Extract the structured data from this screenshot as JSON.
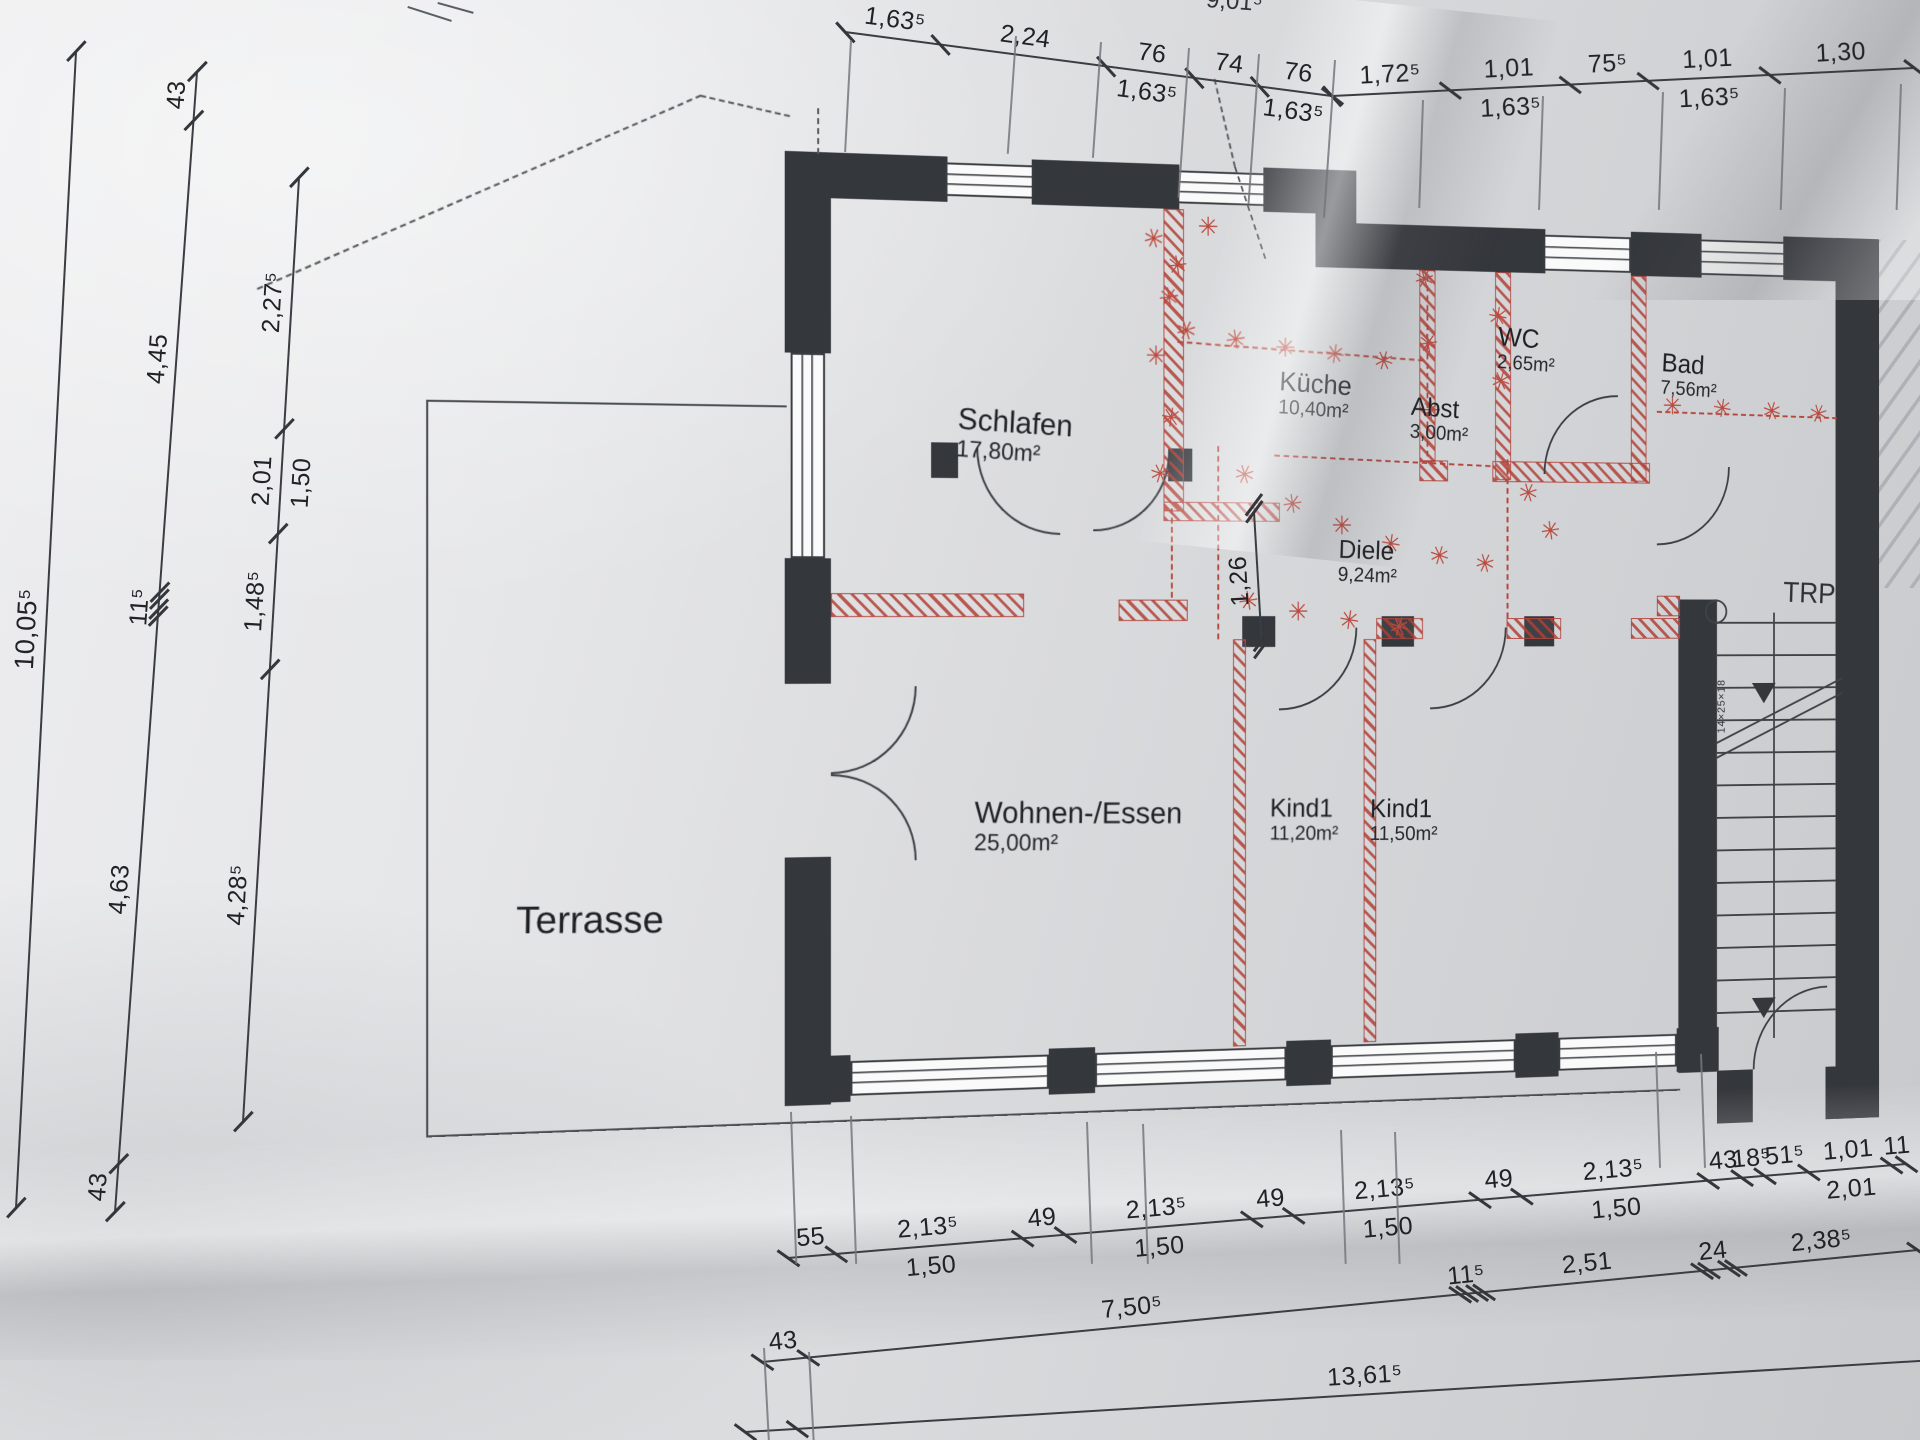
{
  "meta": {
    "kind": "photographed architectural floor plan, German labels"
  },
  "colors": {
    "paper": "#e6e7e9",
    "ink": "#33363b",
    "wall_black": "#34373c",
    "demolition_red": "#b2463e",
    "mark_red": "#bc493e",
    "hatch_gray": "#aeb1b5"
  },
  "labels": {
    "trpha": "TRPHA.",
    "stair_annotation": "14×25×18",
    "top_partial": "9,01⁵"
  },
  "rooms": [
    {
      "id": "schlafen",
      "name": "Schlafen",
      "area": "17,80m²",
      "x": 962,
      "y": 402,
      "size": 31,
      "rot": 3
    },
    {
      "id": "kueche",
      "name": "Küche",
      "area": "10,40m²",
      "x": 1305,
      "y": 358,
      "size": 28,
      "rot": 3
    },
    {
      "id": "abst",
      "name": "Abst",
      "area": "3,00m²",
      "x": 1450,
      "y": 382,
      "size": 27,
      "rot": 3
    },
    {
      "id": "wc",
      "name": "WC",
      "area": "2,65m²",
      "x": 1548,
      "y": 306,
      "size": 28,
      "rot": 3
    },
    {
      "id": "bad",
      "name": "Bad",
      "area": "7,56m²",
      "x": 1735,
      "y": 330,
      "size": 28,
      "rot": 3
    },
    {
      "id": "diele",
      "name": "Diele",
      "area": "9,24m²",
      "x": 1370,
      "y": 532,
      "size": 27,
      "rot": 2
    },
    {
      "id": "wohnen",
      "name": "Wohnen-/Essen",
      "area": "25,00m²",
      "x": 980,
      "y": 801,
      "size": 31,
      "rot": 1
    },
    {
      "id": "kind1a",
      "name": "Kind1",
      "area": "11,20m²",
      "x": 1295,
      "y": 801,
      "size": 27,
      "rot": 1
    },
    {
      "id": "kind1b",
      "name": "Kind1",
      "area": "11,50m²",
      "x": 1405,
      "y": 803,
      "size": 27,
      "rot": 1
    },
    {
      "id": "terrasse",
      "name": "Terrasse",
      "area": "",
      "x": 518,
      "y": 896,
      "size": 38,
      "rot": 1
    }
  ],
  "dimension_chains": [
    {
      "id": "top-left",
      "x1": 845,
      "y1": 32,
      "x2": 1332,
      "y2": 96,
      "segs": [
        {
          "a": "1,63⁵",
          "len": 95
        },
        {
          "a": "2,24",
          "len": 165
        },
        {
          "a": "76",
          "b": "1,63⁵",
          "len": 88
        },
        {
          "a": "74",
          "len": 66
        },
        {
          "a": "76",
          "b": "1,63⁵",
          "len": 72
        }
      ]
    },
    {
      "id": "top-right",
      "x1": 1332,
      "y1": 96,
      "x2": 1914,
      "y2": 68,
      "segs": [
        {
          "a": "1,72⁵",
          "len": 118
        },
        {
          "a": "1,01",
          "b": "1,63⁵",
          "len": 120
        },
        {
          "a": "75⁵",
          "len": 78
        },
        {
          "a": "1,01",
          "b": "1,63⁵",
          "len": 122
        },
        {
          "a": "1,30",
          "len": 145
        }
      ]
    },
    {
      "id": "left-outer",
      "x1": 16,
      "y1": 1208,
      "x2": 76,
      "y2": 52,
      "fs": 27,
      "segs": [
        {
          "a": "10,05⁵",
          "len": 1
        }
      ]
    },
    {
      "id": "left-mid",
      "x1": 115,
      "y1": 1212,
      "x2": 197,
      "y2": 72,
      "segs": [
        {
          "a": "43",
          "len": 45
        },
        {
          "a": "4,63",
          "len": 520
        },
        {
          "a": "11⁵",
          "len": 16,
          "d": 1
        },
        {
          "a": "4,45",
          "len": 455,
          "d": 1
        },
        {
          "a": "43",
          "len": 46
        }
      ]
    },
    {
      "id": "left-inner",
      "x1": 243,
      "y1": 1122,
      "x2": 299,
      "y2": 178,
      "segs": [
        {
          "a": "4,28⁵",
          "len": 450
        },
        {
          "a": "1,48⁵",
          "len": 135
        },
        {
          "a": "2,01",
          "b": "1,50",
          "len": 105
        },
        {
          "a": "2,27⁵",
          "len": 250
        }
      ]
    },
    {
      "id": "bottom-1",
      "x1": 788,
      "y1": 1258,
      "x2": 1906,
      "y2": 1164,
      "segs": [
        {
          "a": "55",
          "len": 48
        },
        {
          "a": "2,13⁵",
          "b": "1,50",
          "len": 185
        },
        {
          "a": "49",
          "len": 42
        },
        {
          "a": "2,13⁵",
          "b": "1,50",
          "len": 185
        },
        {
          "a": "49",
          "len": 42
        },
        {
          "a": "2,13⁵",
          "b": "1,50",
          "len": 185
        },
        {
          "a": "49",
          "len": 42
        },
        {
          "a": "2,13⁵",
          "b": "1,50",
          "len": 185
        },
        {
          "a": "43",
          "len": 34
        },
        {
          "a": "18⁵",
          "len": 22
        },
        {
          "a": "51⁵",
          "len": 44
        },
        {
          "a": "1,01",
          "b": "2,01",
          "len": 82
        },
        {
          "a": "11",
          "len": 15
        }
      ]
    },
    {
      "id": "bottom-2",
      "x1": 762,
      "y1": 1362,
      "x2": 1918,
      "y2": 1250,
      "segs": [
        {
          "a": "43",
          "len": 46
        },
        {
          "a": "7,50⁵",
          "len": 652
        },
        {
          "a": "11⁵",
          "len": 17,
          "d": 1
        },
        {
          "a": "2,51",
          "len": 225,
          "d": 1
        },
        {
          "a": "24",
          "len": 27,
          "d": 1
        },
        {
          "a": "2,38⁵",
          "len": 190,
          "d": 1
        }
      ]
    },
    {
      "id": "bottom-3",
      "x1": 745,
      "y1": 1432,
      "x2": 1935,
      "y2": 1360,
      "segs": [
        {
          "len": 52
        },
        {
          "a": "13,61⁵",
          "len": 1140
        }
      ]
    },
    {
      "id": "diele-width",
      "x1": 1262,
      "y1": 648,
      "x2": 1254,
      "y2": 512,
      "ed": 1,
      "segs": [
        {
          "a": "1,26",
          "len": 1,
          "d": 1
        }
      ]
    }
  ],
  "plan_geometry": {
    "walls": [
      [
        785,
        150,
        47,
        202
      ],
      [
        785,
        558,
        47,
        126
      ],
      [
        785,
        858,
        47,
        249
      ],
      [
        785,
        150,
        167,
        46
      ],
      [
        1040,
        150,
        157,
        46
      ],
      [
        1288,
        150,
        102,
        46
      ],
      [
        1345,
        150,
        45,
        102
      ],
      [
        1390,
        205,
        212,
        47
      ],
      [
        1700,
        205,
        82,
        47
      ],
      [
        1878,
        205,
        112,
        47
      ],
      [
        1940,
        205,
        52,
        957
      ],
      [
        785,
        1058,
        67,
        47
      ],
      [
        1058,
        1058,
        49,
        47
      ],
      [
        1313,
        1058,
        49,
        47
      ],
      [
        1568,
        1058,
        49,
        47
      ],
      [
        1753,
        1058,
        49,
        47
      ],
      [
        1755,
        598,
        45,
        508
      ],
      [
        1800,
        1105,
        42,
        57
      ],
      [
        1928,
        1105,
        64,
        57
      ],
      [
        935,
        440,
        28,
        36
      ],
      [
        1185,
        443,
        26,
        34
      ],
      [
        1265,
        616,
        36,
        32
      ],
      [
        1418,
        616,
        36,
        32
      ],
      [
        1578,
        616,
        34,
        32
      ]
    ],
    "red_walls": [
      [
        1180,
        196,
        22,
        312
      ],
      [
        832,
        593,
        200,
        24
      ],
      [
        1132,
        599,
        74,
        22
      ],
      [
        1180,
        498,
        126,
        20
      ],
      [
        1255,
        640,
        14,
        422
      ],
      [
        1398,
        640,
        14,
        422
      ],
      [
        1460,
        252,
        18,
        202
      ],
      [
        1545,
        252,
        18,
        220
      ],
      [
        1700,
        252,
        18,
        220
      ],
      [
        1460,
        452,
        32,
        22
      ],
      [
        1542,
        452,
        180,
        22
      ],
      [
        1412,
        618,
        52,
        22
      ],
      [
        1558,
        618,
        62,
        22
      ],
      [
        1700,
        618,
        57,
        22
      ],
      [
        1730,
        594,
        27,
        22
      ]
    ],
    "red_dashed": [
      [
        1190,
        505,
        92,
        90
      ],
      [
        1240,
        440,
        200,
        90
      ],
      [
        1470,
        258,
        190,
        90
      ],
      [
        1560,
        450,
        168,
        90
      ],
      [
        1195,
        332,
        270,
        3
      ],
      [
        1730,
        396,
        212,
        1
      ],
      [
        1300,
        448,
        240,
        2
      ]
    ],
    "windows": [
      [
        950,
        156,
        92,
        34,
        "h"
      ],
      [
        1195,
        156,
        95,
        34,
        "h"
      ],
      [
        1600,
        211,
        100,
        38,
        "h"
      ],
      [
        1780,
        211,
        100,
        38,
        "h"
      ],
      [
        791,
        352,
        35,
        206,
        "v"
      ],
      [
        852,
        1064,
        206,
        35,
        "h"
      ],
      [
        1107,
        1064,
        206,
        35,
        "h"
      ],
      [
        1362,
        1064,
        206,
        35,
        "h"
      ],
      [
        1617,
        1064,
        136,
        35,
        "h"
      ]
    ],
    "doors": [
      [
        832,
        687,
        88,
        "br"
      ],
      [
        832,
        775,
        88,
        "tr"
      ],
      [
        982,
        445,
        88,
        "bl"
      ],
      [
        1105,
        447,
        82,
        "br"
      ],
      [
        1305,
        628,
        86,
        "br"
      ],
      [
        1472,
        628,
        86,
        "br"
      ],
      [
        1600,
        380,
        85,
        "tl"
      ],
      [
        1730,
        455,
        85,
        "br"
      ],
      [
        1842,
        1017,
        88,
        "tl"
      ]
    ],
    "xmarks": [
      [
        1170,
        228
      ],
      [
        1186,
        288
      ],
      [
        1172,
        348
      ],
      [
        1188,
        412
      ],
      [
        1176,
        470
      ],
      [
        1205,
        322
      ],
      [
        1258,
        330
      ],
      [
        1312,
        337
      ],
      [
        1366,
        343
      ],
      [
        1420,
        349
      ],
      [
        1466,
        262
      ],
      [
        1470,
        330
      ],
      [
        1473,
        400
      ],
      [
        1548,
        300
      ],
      [
        1551,
        368
      ],
      [
        1268,
        470
      ],
      [
        1320,
        500
      ],
      [
        1374,
        522
      ],
      [
        1428,
        541
      ],
      [
        1482,
        553
      ],
      [
        1534,
        561
      ],
      [
        1272,
        601
      ],
      [
        1326,
        612
      ],
      [
        1382,
        621
      ],
      [
        1437,
        628
      ],
      [
        1583,
        486
      ],
      [
        1608,
        526
      ],
      [
        1748,
        391
      ],
      [
        1806,
        393
      ],
      [
        1864,
        395
      ],
      [
        1920,
        397
      ],
      [
        1195,
        255
      ],
      [
        1228,
        214
      ]
    ],
    "guides": [
      [
        850,
        40,
        112,
        3
      ],
      [
        1015,
        36,
        118,
        4
      ],
      [
        1100,
        42,
        116,
        4
      ],
      [
        1188,
        48,
        150,
        4
      ],
      [
        1258,
        54,
        150,
        4
      ],
      [
        1334,
        60,
        158,
        4
      ],
      [
        1422,
        100,
        108,
        2
      ],
      [
        1542,
        96,
        114,
        2
      ],
      [
        1662,
        92,
        118,
        2
      ],
      [
        1784,
        88,
        122,
        2
      ],
      [
        1900,
        84,
        126,
        2
      ],
      [
        790,
        1112,
        152,
        -2
      ],
      [
        850,
        1116,
        148,
        -2
      ],
      [
        1086,
        1122,
        142,
        -2
      ],
      [
        1142,
        1124,
        140,
        -2
      ],
      [
        1340,
        1130,
        134,
        -2
      ],
      [
        1394,
        1132,
        132,
        -2
      ],
      [
        763,
        1348,
        96,
        -3
      ],
      [
        808,
        1352,
        94,
        -3
      ],
      [
        1655,
        1052,
        116,
        -2
      ],
      [
        1700,
        1054,
        114,
        -2
      ]
    ],
    "thin_lines": [
      [
        433,
        405,
        433,
        1125
      ],
      [
        433,
        405,
        787,
        405
      ],
      [
        433,
        1123,
        1757,
        1123
      ]
    ],
    "dashed_lines": [
      [
        270,
        300,
        700,
        97
      ],
      [
        700,
        97,
        790,
        114
      ],
      [
        820,
        106,
        820,
        152
      ],
      [
        1236,
        60,
        1258,
        150
      ],
      [
        1258,
        150,
        1291,
        244
      ]
    ],
    "scribbles": [
      [
        408,
        6,
        452,
        20
      ],
      [
        438,
        2,
        474,
        12
      ]
    ],
    "hatch": [
      1990,
      205,
      115,
      380
    ],
    "stairs": {
      "x": 1800,
      "y": 622,
      "w": 140,
      "steps": 13,
      "gap": 35,
      "rail": [
        1866,
        612,
        460
      ],
      "arrows": [
        [
          1841,
          688
        ],
        [
          1841,
          1028
        ]
      ],
      "circle": [
        1786,
        598
      ],
      "diag": [
        [
          1798,
          752,
          165,
          -25
        ],
        [
          1798,
          768,
          165,
          -25
        ]
      ],
      "ann": [
        1800,
        742
      ]
    }
  }
}
